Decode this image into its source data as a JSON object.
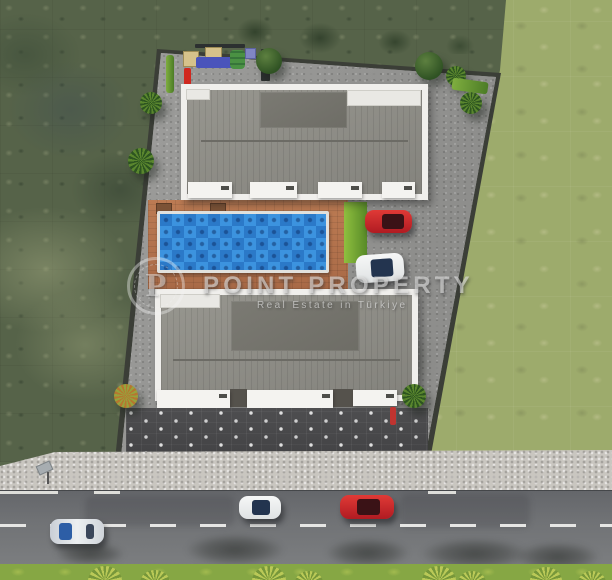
{
  "watermark": {
    "logo_letter": "P",
    "title": "POINT PROPERTY",
    "subtitle": "Real Estate in Türkiye"
  },
  "scene": {
    "type": "aerial-3d-site-plan",
    "buildings_count": 2,
    "swimming_pool_count": 1,
    "parked_cars": [
      {
        "color": "red"
      },
      {
        "color": "white"
      }
    ],
    "road_cars": [
      {
        "color": "silver-blue"
      },
      {
        "color": "white"
      },
      {
        "color": "red"
      }
    ],
    "playground_items": [
      "red slide",
      "tan canopies",
      "blue mat",
      "green toy",
      "purple canopy",
      "benches"
    ]
  },
  "colors": {
    "pool_light": "#3c93df",
    "pool_dark": "#2b79c8",
    "deck_terracotta": "#b5764f",
    "roof_gray": "#8e8d89",
    "building_trim": "#f0efec",
    "scrub_green": "#566349",
    "lawn_green": "#9dab6c",
    "asphalt": "#6f7174",
    "roadside_grass": "#86a744",
    "car_red": "#d2242b",
    "gravel": "#9a9a98",
    "courtyard_pavers": "#4c4c4e",
    "sidewalk": "#c9c6c0"
  }
}
